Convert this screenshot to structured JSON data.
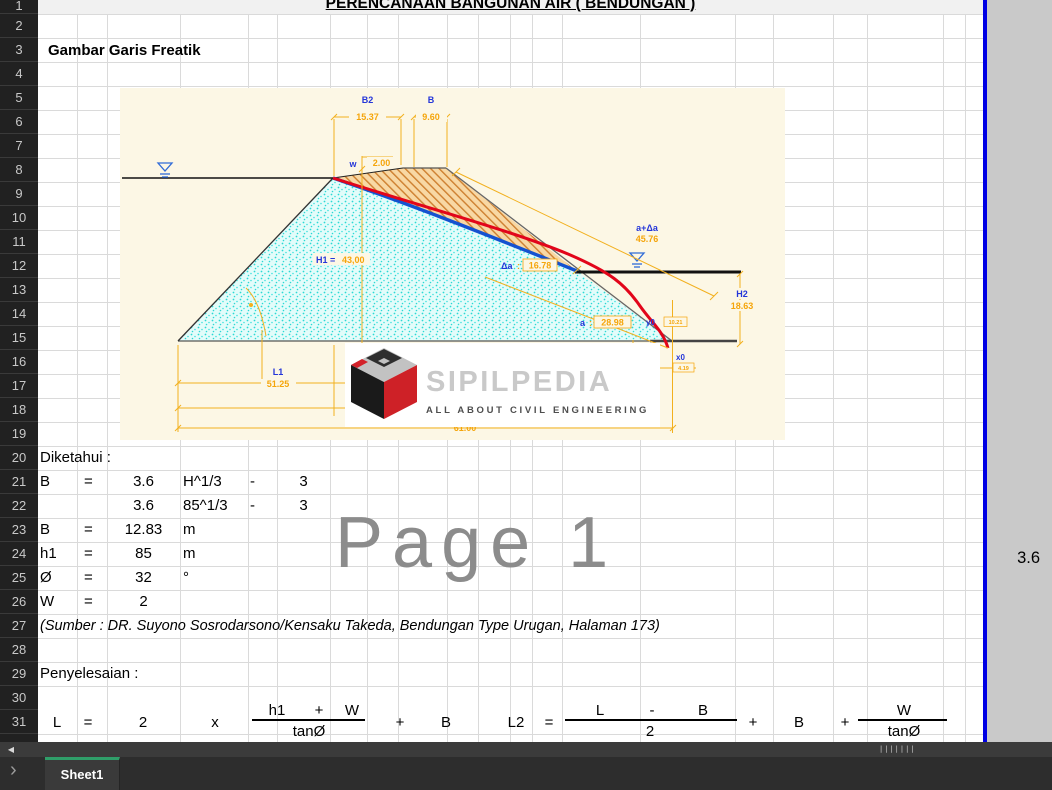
{
  "title": "PERENCANAAN BANGUNAN AIR ( BENDUNGAN )",
  "section_heading": "Gambar Garis Freatik",
  "watermark": "Page 1",
  "outside_value": "3.6",
  "row_numbers": [
    1,
    2,
    3,
    4,
    5,
    6,
    7,
    8,
    9,
    10,
    11,
    12,
    13,
    14,
    15,
    16,
    17,
    18,
    19,
    20,
    21,
    22,
    23,
    24,
    25,
    26,
    27,
    28,
    29,
    30,
    31
  ],
  "diagram": {
    "labels": {
      "b2": "B2",
      "b2_value": "15.37",
      "b": "B",
      "b_value": "9.60",
      "w": "w",
      "w_value": "2.00",
      "h1": "H1 =",
      "h1_value": "43,00",
      "da": "Δa",
      "da_colon": ":",
      "da_value": "16.78",
      "a": "a",
      "a_colon": ":",
      "a_value": "28.98",
      "a_da": "a+Δa",
      "a_da_value": "45.76",
      "h2": "H2",
      "h2_value": "18.63",
      "y0": "y0",
      "y0_value": "10.21",
      "x0": "x0",
      "x0_value": "4.19",
      "l1": "L1",
      "l1_value": "51.25",
      "base_value": "61.00"
    },
    "logo": {
      "name": "SIPILPEDIA",
      "tagline": "ALL ABOUT CIVIL ENGINEERING"
    }
  },
  "cells": [
    {
      "row": 20,
      "col": "A",
      "text": "Diketahui :",
      "wide": true
    },
    {
      "row": 21,
      "col": "A",
      "text": "B"
    },
    {
      "row": 21,
      "col": "B",
      "text": "="
    },
    {
      "row": 21,
      "col": "C",
      "text": "3.6"
    },
    {
      "row": 21,
      "col": "D",
      "text": "H^1/3"
    },
    {
      "row": 21,
      "col": "E",
      "text": "-"
    },
    {
      "row": 21,
      "col": "F",
      "text": "3"
    },
    {
      "row": 22,
      "col": "C",
      "text": "3.6"
    },
    {
      "row": 22,
      "col": "D",
      "text": "85^1/3"
    },
    {
      "row": 22,
      "col": "E",
      "text": "-"
    },
    {
      "row": 22,
      "col": "F",
      "text": "3"
    },
    {
      "row": 23,
      "col": "A",
      "text": "B"
    },
    {
      "row": 23,
      "col": "B",
      "text": "="
    },
    {
      "row": 23,
      "col": "C",
      "text": "12.83"
    },
    {
      "row": 23,
      "col": "D",
      "text": "m"
    },
    {
      "row": 24,
      "col": "A",
      "text": "h1"
    },
    {
      "row": 24,
      "col": "B",
      "text": "="
    },
    {
      "row": 24,
      "col": "C",
      "text": "85"
    },
    {
      "row": 24,
      "col": "D",
      "text": "m"
    },
    {
      "row": 25,
      "col": "A",
      "text": "Ø"
    },
    {
      "row": 25,
      "col": "B",
      "text": "="
    },
    {
      "row": 25,
      "col": "C",
      "text": "32"
    },
    {
      "row": 25,
      "col": "D",
      "text": "°"
    },
    {
      "row": 26,
      "col": "A",
      "text": "W"
    },
    {
      "row": 26,
      "col": "B",
      "text": "="
    },
    {
      "row": 26,
      "col": "C",
      "text": "2"
    },
    {
      "row": 27,
      "col": "A",
      "text": "(Sumber : DR. Suyono Sosrodarsono/Kensaku Takeda, Bendungan Type Urugan, Halaman 173)",
      "wide": true,
      "italic": true
    },
    {
      "row": 29,
      "col": "A",
      "text": "Penyelesaian :",
      "wide": true
    }
  ],
  "formula": {
    "lhs": "L",
    "eq": "=",
    "coef": "2",
    "times": "x",
    "f1_num": [
      "h1",
      "+",
      "W"
    ],
    "f1_den": "tanØ",
    "plus_a": "+",
    "var_b": "B",
    "lhs2": "L2",
    "eq2": "=",
    "f2_num": [
      "L",
      "-",
      "B"
    ],
    "f2_den": "2",
    "plus_b": "+",
    "var_b2": "B",
    "plus_c": "+",
    "f3_num": "W",
    "f3_den": "tanØ"
  },
  "scrollbar": {
    "left_arrow": "◀",
    "grip": "|||||||"
  },
  "tabbar": {
    "chevron": "›",
    "tab": "Sheet1"
  },
  "colors": {
    "dim_line": "#f2b01e",
    "label_blue": "#2436d9",
    "value_orange": "#f5a50a",
    "phreatic_blue": "#1452d0",
    "phreatic_red": "#e2051a",
    "page_break_blue": "#0000e4",
    "tab_green": "#2f9e69",
    "outside_gray": "#c9c9c9",
    "header_dark": "#212121",
    "diagram_bg": "#fcf7e5"
  }
}
